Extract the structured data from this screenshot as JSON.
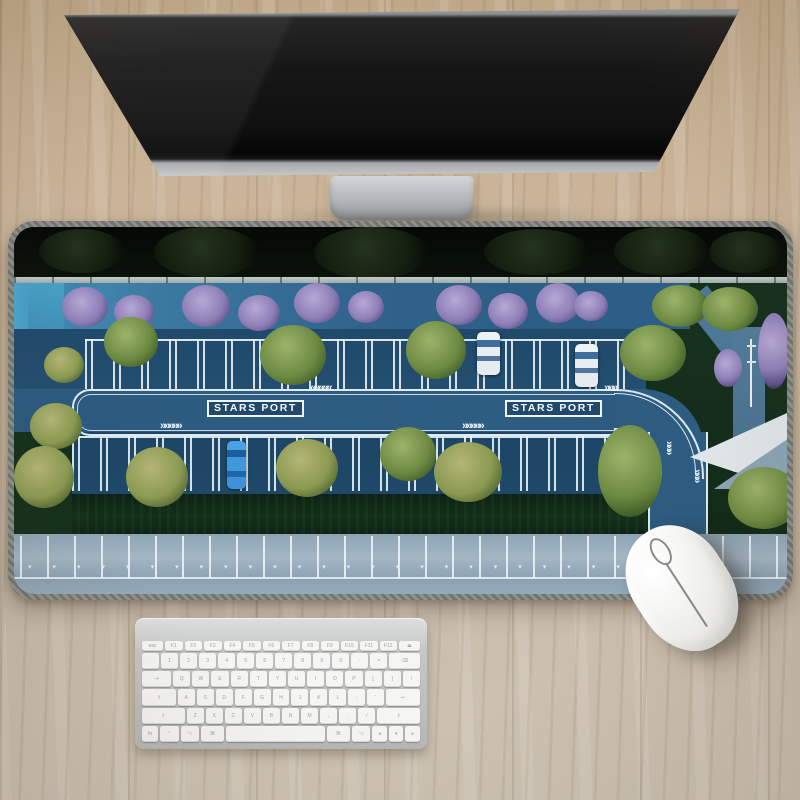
{
  "scene_title": "Desk setup with STARS PORT parking-lot desk mat",
  "monitor": {
    "screen_color": "#141414",
    "stand_color": "#b3b5b7"
  },
  "mousepad": {
    "sign_left": "STARS PORT",
    "sign_right": "STARS PORT",
    "marks": {
      "chevrons_left": "«««««",
      "chevrons_right": "»»»»»",
      "chevrons_short": "»»»",
      "chevrons_down": "»»»",
      "stall_arrows": "▾▾▾▾▾▾▾▾▾▾▾▾▾▾▾▾▾▾▾▾▾▾▾▾▾▾▾"
    },
    "colors": {
      "edge_stitch": "#7f817c",
      "road_blue": "#2d5c80",
      "asphalt": "#20496b",
      "markings": "#eef6fa",
      "upper_road": "#30638c",
      "bottom_road": "#97acbb",
      "hedge": "#122b17",
      "tree_green": "#6d8a42",
      "tree_olive": "#8a9a52",
      "tree_purple": "#8d7fb6",
      "night_trees": "#0b120a"
    },
    "cars": [
      {
        "color": "white",
        "position": "top row left"
      },
      {
        "color": "white",
        "position": "top row right"
      },
      {
        "color": "blue",
        "position": "bottom row"
      }
    ]
  },
  "mouse": {
    "body_color": "#f3f3f0"
  },
  "keyboard": {
    "frame_color": "#c5c7c6",
    "key_color": "#f5f5f3",
    "rows": [
      [
        "esc",
        "F1",
        "F2",
        "F3",
        "F4",
        "F5",
        "F6",
        "F7",
        "F8",
        "F9",
        "F10",
        "F11",
        "F12",
        "⏏"
      ],
      [
        "`",
        "1",
        "2",
        "3",
        "4",
        "5",
        "6",
        "7",
        "8",
        "9",
        "0",
        "-",
        "=",
        "⌫"
      ],
      [
        "⇥",
        "Q",
        "W",
        "E",
        "R",
        "T",
        "Y",
        "U",
        "I",
        "O",
        "P",
        "[",
        "]",
        "\\"
      ],
      [
        "⇪",
        "A",
        "S",
        "D",
        "F",
        "G",
        "H",
        "J",
        "K",
        "L",
        ";",
        "'",
        "↩"
      ],
      [
        "⇧",
        "Z",
        "X",
        "C",
        "V",
        "B",
        "N",
        "M",
        ",",
        ".",
        "/",
        "⇧"
      ],
      [
        "fn",
        "⌃",
        "⌥",
        "⌘",
        "SPACE",
        "⌘",
        "⌥",
        "◂",
        "▾",
        "▸"
      ]
    ]
  },
  "desk": {
    "surface_color": "#c9b69c"
  }
}
